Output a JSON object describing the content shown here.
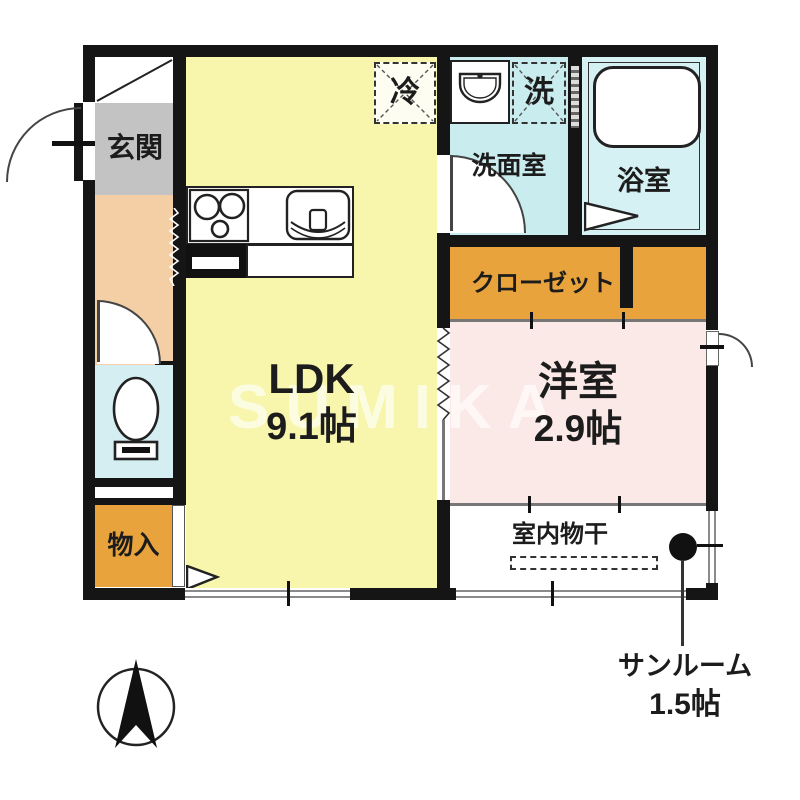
{
  "watermark": "SUMIKA",
  "labels": {
    "genkan": "玄関",
    "ldk": "LDK",
    "ldk_size": "9.1帖",
    "washroom": "洗面室",
    "bathroom": "浴室",
    "closet": "クローゼット",
    "western": "洋室",
    "western_size": "2.9帖",
    "storage": "物入",
    "drying": "室内物干",
    "sunroom": "サンルーム",
    "sunroom_size": "1.5帖",
    "fridge": "冷",
    "washer": "洗"
  },
  "colors": {
    "wall": "#151515",
    "ldk": "#f8f6ad",
    "western_room": "#fbe9e8",
    "closet": "#e8a33d",
    "storage": "#e8a33d",
    "corridor": "#f4cfa6",
    "toilet": "#d5eef2",
    "washroom": "#c9ecef",
    "bathroom": "#d6f1f4",
    "genkan_floor": "#c3c3c3",
    "watermark": "rgba(255,255,255,0.62)"
  }
}
